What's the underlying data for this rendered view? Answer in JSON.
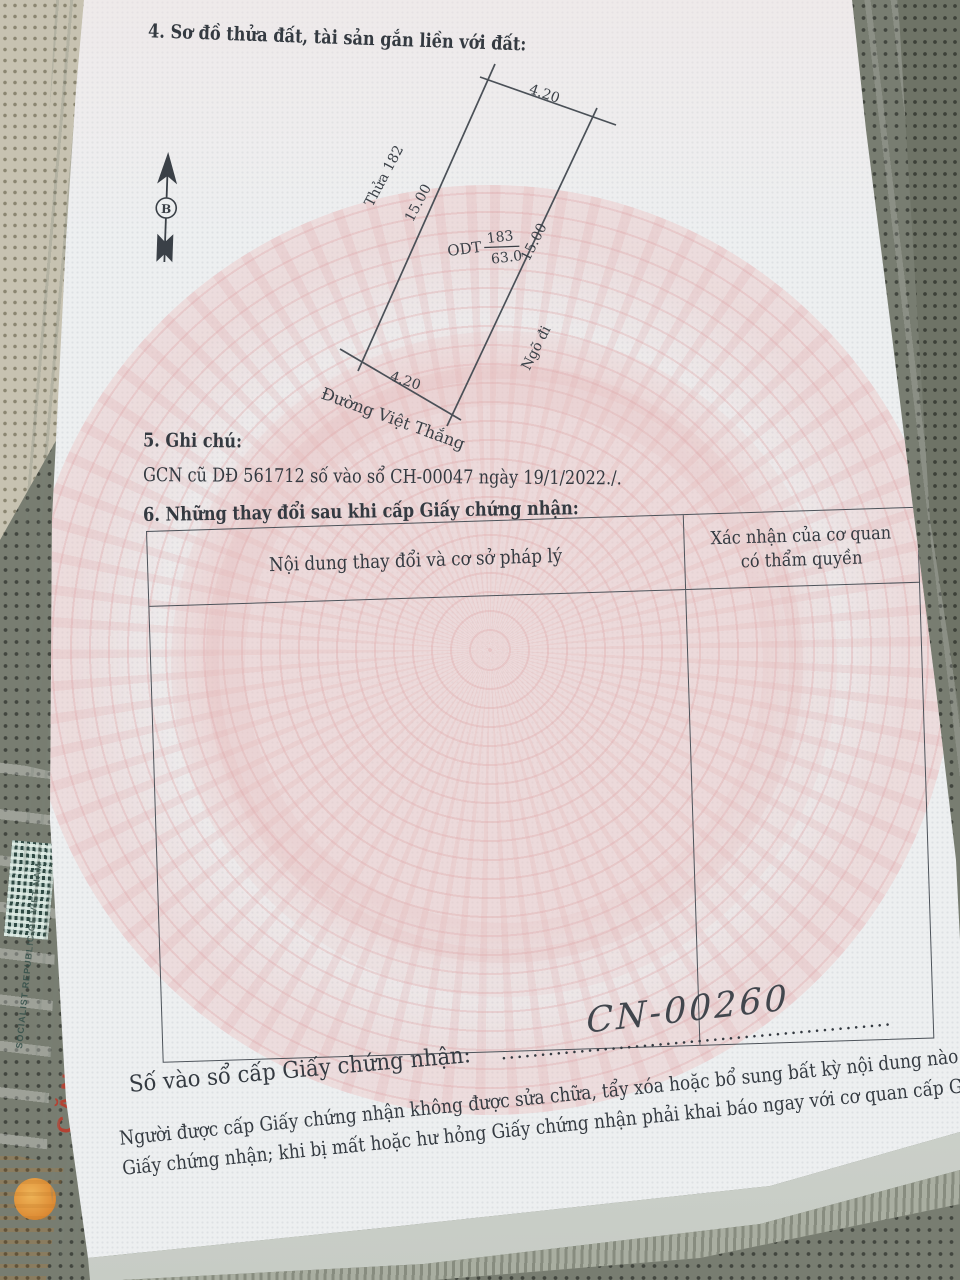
{
  "page": {
    "section4": {
      "title": "4. Sơ đồ thửa đất, tài sản gắn liền với đất:"
    },
    "diagram": {
      "north_label": "B",
      "dim_top": "4.20",
      "dim_left": "15.00",
      "dim_right": "15.00",
      "dim_bottom": "4.20",
      "neighbor_label": "Thửa 182",
      "land_use_code": "ODT",
      "plot_number": "183",
      "plot_area": "63.0",
      "alley_label": "Ngõ đi",
      "road_label": "Đường Việt Thắng"
    },
    "section5": {
      "title": "5. Ghi chú:",
      "text": "GCN cũ DĐ 561712 số vào sổ CH-00047 ngày 19/1/2022./."
    },
    "section6": {
      "title": "6. Những thay đổi sau khi cấp Giấy chứng nhận:",
      "table": {
        "col1_header": "Nội dung thay đổi và cơ sở pháp lý",
        "col2_header_line1": "Xác nhận của cơ quan",
        "col2_header_line2": "có thẩm quyền"
      }
    },
    "footer": {
      "serial_label": "Số vào sổ cấp Giấy chứng nhận:",
      "serial_leader_dots": "..................................................",
      "serial_value": "CN-00260",
      "note_line1": "Người được cấp Giấy chứng nhận không được sửa chữa, tẩy xóa hoặc bổ sung bất kỳ nội dung nào trong",
      "note_line2": "Giấy chứng nhận; khi bị mất hoặc hư hỏng Giấy chứng nhận phải khai báo ngay với cơ quan cấp Giấy."
    }
  },
  "background": {
    "id_card_text_red": "CĂN CƯỚC",
    "id_card_text_small": "SOCIALIST REPUBLIC OF VIET NAM"
  },
  "colors": {
    "ink": "#343a41",
    "watermark_pink": "#e2b4b6",
    "page": "#edeff0",
    "seat": "#787d71",
    "card_red": "#b44233",
    "card_teal": "#a8cabb"
  }
}
